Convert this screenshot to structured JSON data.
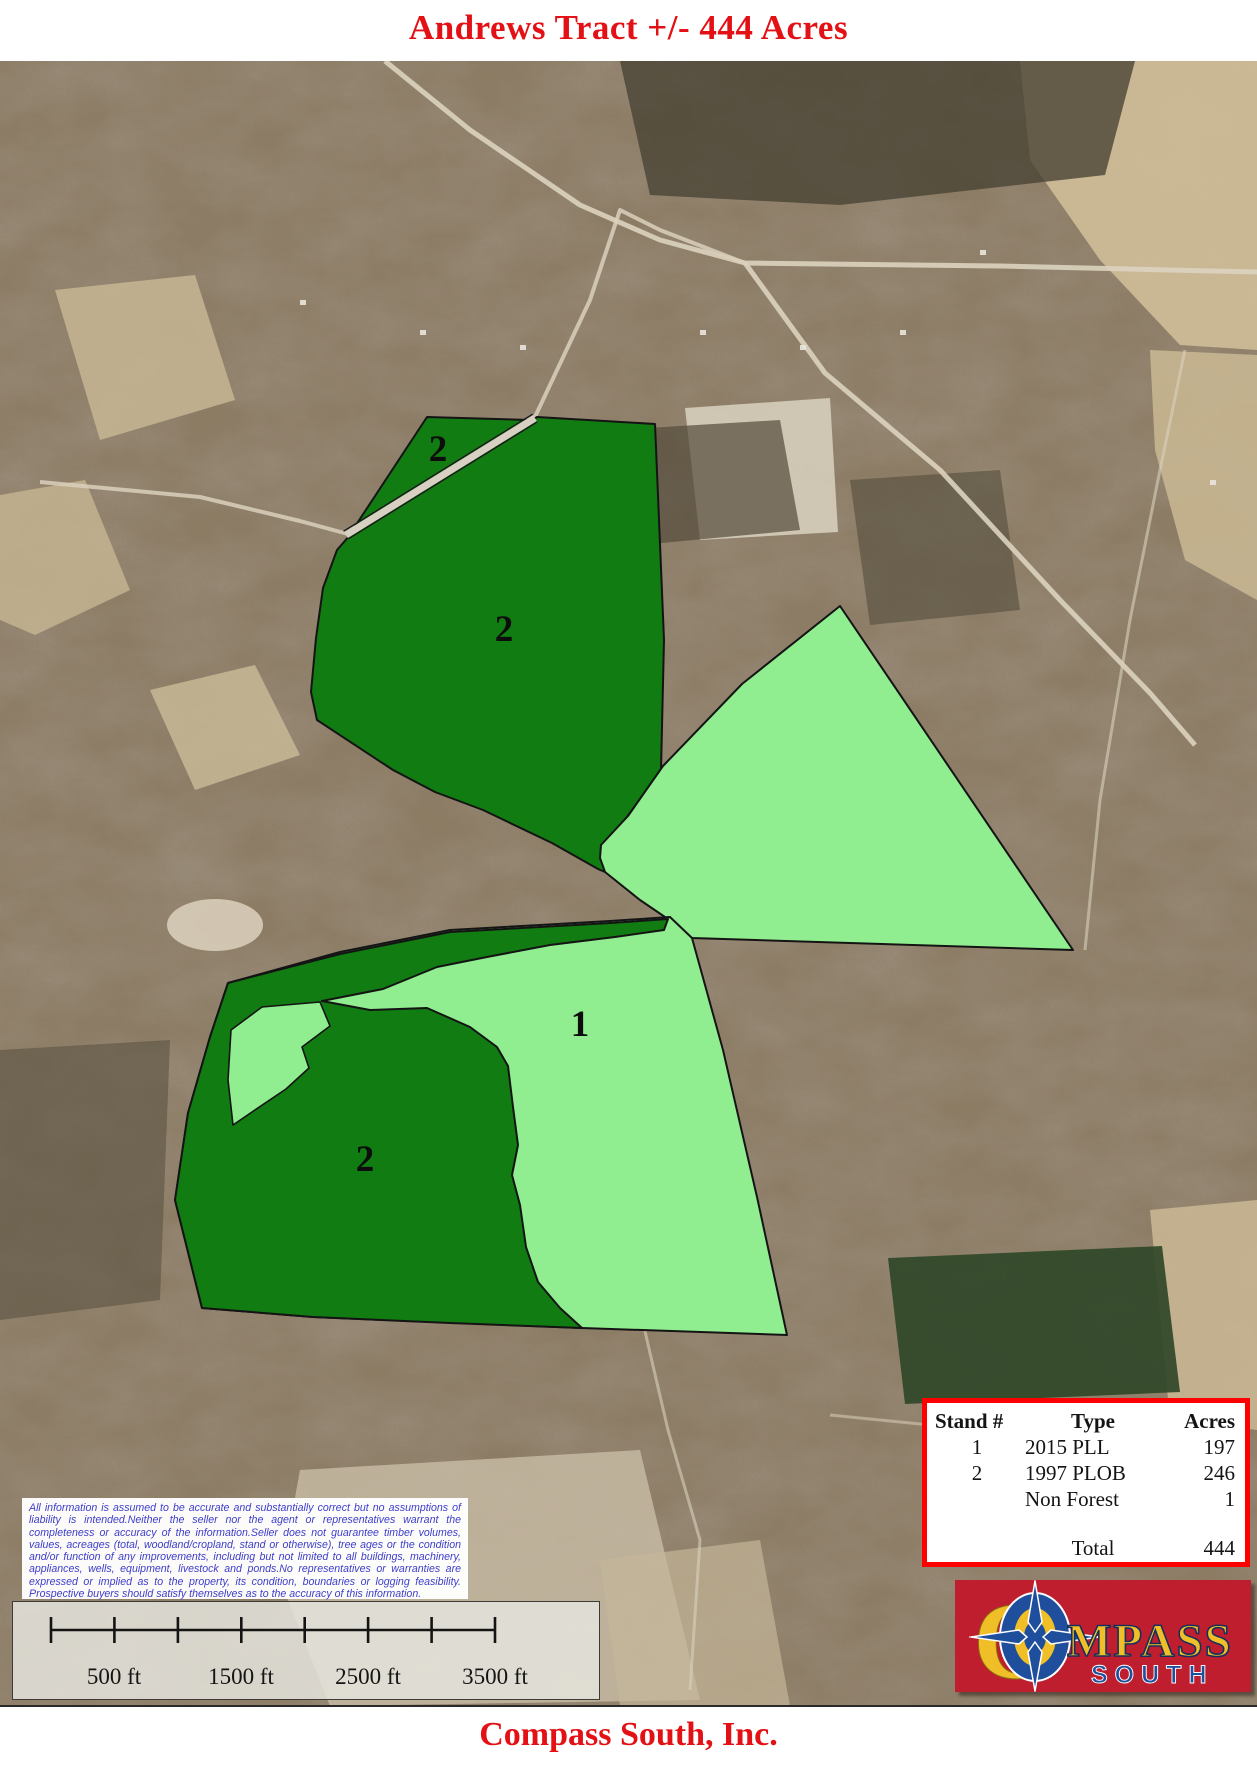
{
  "page": {
    "title": "Andrews Tract +/- 444 Acres",
    "footer": "Compass South, Inc."
  },
  "colors": {
    "title_red": "#e31115",
    "stand1_light_green": "#90ee90",
    "stand2_dark_green": "#117c11",
    "boundary_black": "#141414",
    "table_border_red": "#ff0000",
    "disclaimer_blue": "#3d3dca",
    "logo_crimson": "#be1e2d",
    "logo_gold": "#f0be27",
    "logo_blue": "#1f4e9c"
  },
  "map": {
    "stand_labels": [
      {
        "text": "2"
      },
      {
        "text": "2"
      },
      {
        "text": "1"
      },
      {
        "text": "2"
      }
    ]
  },
  "legend_table": {
    "headers": [
      "Stand #",
      "Type",
      "Acres"
    ],
    "rows": [
      {
        "stand": "1",
        "type": "2015 PLL",
        "acres": "197"
      },
      {
        "stand": "2",
        "type": "1997 PLOB",
        "acres": "246"
      },
      {
        "stand": "",
        "type": "Non Forest",
        "acres": "1"
      }
    ],
    "total_label": "Total",
    "total_value": "444"
  },
  "disclaimer": {
    "text": "All information is assumed to be accurate and substantially correct but no assumptions of liability is intended.Neither the seller nor the agent or representatives warrant the completeness or accuracy of the information.Seller does not guarantee timber volumes, values, acreages (total, woodland/cropland, stand or otherwise), tree ages or the condition and/or function of any improvements, including but not limited to all buildings, machinery, appliances, wells, equipment, livestock and ponds.No representatives or warranties are expressed or implied as to the property, its condition, boundaries or logging feasibility. Prospective buyers should satisfy themselves as to the accuracy of this information."
  },
  "scale_bar": {
    "labels": [
      "500 ft",
      "1500 ft",
      "2500 ft",
      "3500 ft"
    ]
  },
  "logo": {
    "initial": "C",
    "rest": "MPASS",
    "sub": "SOUTH"
  }
}
